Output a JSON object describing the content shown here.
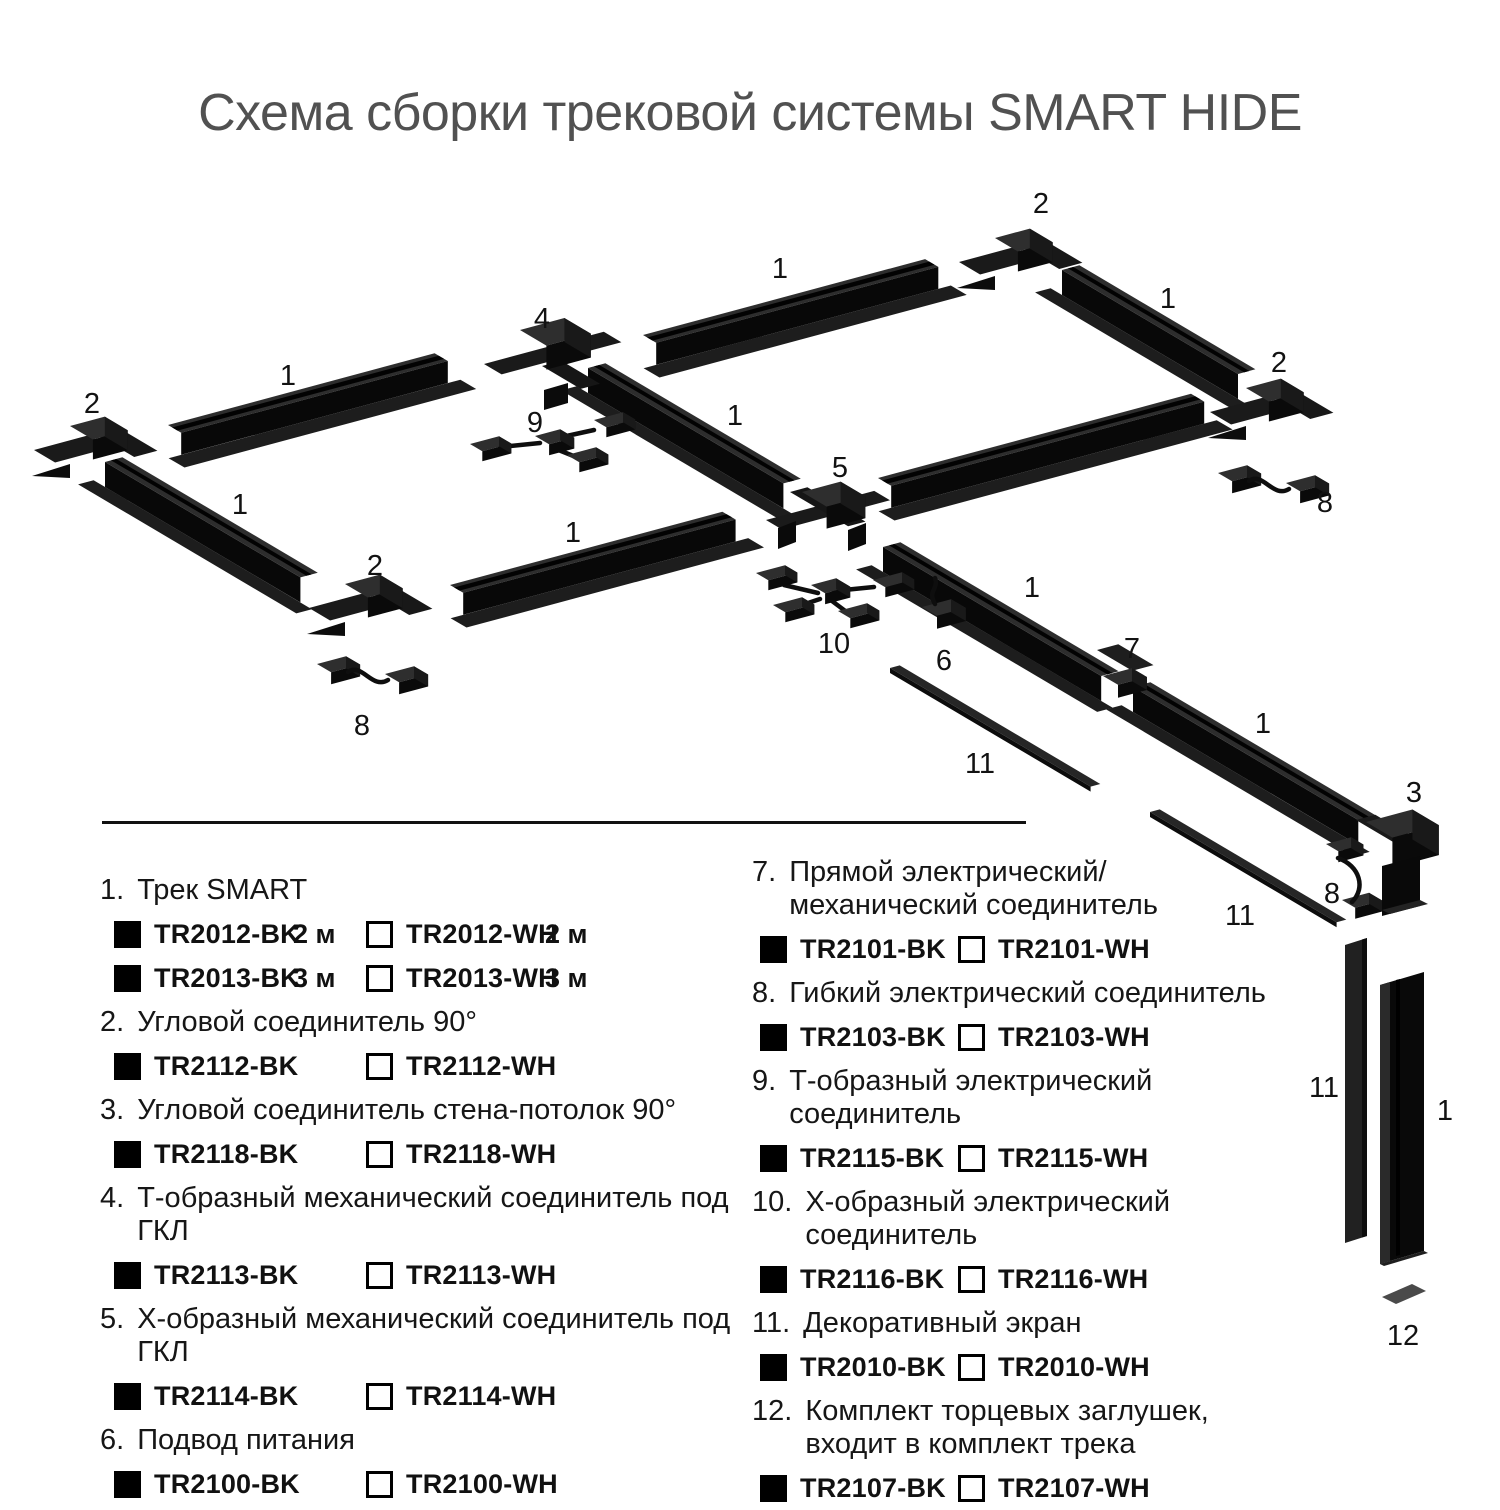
{
  "title": "Схема сборки трековой системы SMART HIDE",
  "colors": {
    "black_variant": "#000000",
    "white_variant": "#FFFFFF",
    "title_gray": "#515151",
    "track_black": "#0a0a0a"
  },
  "diagram": {
    "labels": [
      {
        "t": "2",
        "x": 1041,
        "y": 213
      },
      {
        "t": "1",
        "x": 780,
        "y": 278
      },
      {
        "t": "1",
        "x": 1168,
        "y": 308
      },
      {
        "t": "4",
        "x": 542,
        "y": 328
      },
      {
        "t": "2",
        "x": 1279,
        "y": 372
      },
      {
        "t": "1",
        "x": 288,
        "y": 385
      },
      {
        "t": "2",
        "x": 92,
        "y": 413
      },
      {
        "t": "9",
        "x": 535,
        "y": 432
      },
      {
        "t": "1",
        "x": 735,
        "y": 425
      },
      {
        "t": "5",
        "x": 840,
        "y": 477
      },
      {
        "t": "8",
        "x": 1325,
        "y": 512
      },
      {
        "t": "1",
        "x": 240,
        "y": 514
      },
      {
        "t": "1",
        "x": 573,
        "y": 542
      },
      {
        "t": "2",
        "x": 375,
        "y": 575
      },
      {
        "t": "1",
        "x": 1032,
        "y": 597
      },
      {
        "t": "10",
        "x": 834,
        "y": 653
      },
      {
        "t": "7",
        "x": 1132,
        "y": 658
      },
      {
        "t": "6",
        "x": 944,
        "y": 670
      },
      {
        "t": "1",
        "x": 1263,
        "y": 733
      },
      {
        "t": "8",
        "x": 362,
        "y": 735
      },
      {
        "t": "11",
        "x": 980,
        "y": 773
      },
      {
        "t": "3",
        "x": 1414,
        "y": 802
      },
      {
        "t": "8",
        "x": 1332,
        "y": 903
      },
      {
        "t": "11",
        "x": 1240,
        "y": 925
      },
      {
        "t": "11",
        "x": 1324,
        "y": 1097
      },
      {
        "t": "1",
        "x": 1445,
        "y": 1120
      },
      {
        "t": "12",
        "x": 1403,
        "y": 1345
      }
    ]
  },
  "legend": {
    "left": [
      {
        "num": "1.",
        "name_lines": [
          "Трек SMART"
        ],
        "rows": [
          {
            "bk": "TR2012-BK",
            "bk_len": "2 м",
            "wh": "TR2012-WH",
            "wh_len": "2 м"
          },
          {
            "bk": "TR2013-BK",
            "bk_len": "3 м",
            "wh": "TR2013-WH",
            "wh_len": "3 м"
          }
        ]
      },
      {
        "num": "2.",
        "name_lines": [
          "Угловой соединитель 90°"
        ],
        "rows": [
          {
            "bk": "TR2112-BK",
            "wh": "TR2112-WH"
          }
        ]
      },
      {
        "num": "3.",
        "name_lines": [
          "Угловой соединитель стена-потолок 90°"
        ],
        "rows": [
          {
            "bk": "TR2118-BK",
            "wh": "TR2118-WH"
          }
        ]
      },
      {
        "num": "4.",
        "name_lines": [
          "Т-образный механический соединитель под ГКЛ"
        ],
        "rows": [
          {
            "bk": "TR2113-BK",
            "wh": "TR2113-WH"
          }
        ]
      },
      {
        "num": "5.",
        "name_lines": [
          "Х-образный механический соединитель под ГКЛ"
        ],
        "rows": [
          {
            "bk": "TR2114-BK",
            "wh": "TR2114-WH"
          }
        ]
      },
      {
        "num": "6.",
        "name_lines": [
          "Подвод питания"
        ],
        "rows": [
          {
            "bk": "TR2100-BK",
            "wh": "TR2100-WH"
          }
        ]
      }
    ],
    "right": [
      {
        "num": "7.",
        "name_lines": [
          "Прямой электрический/",
          "механический соединитель"
        ],
        "rows": [
          {
            "bk": "TR2101-BK",
            "wh": "TR2101-WH"
          }
        ]
      },
      {
        "num": "8.",
        "name_lines": [
          "Гибкий электрический соединитель"
        ],
        "rows": [
          {
            "bk": "TR2103-BK",
            "wh": "TR2103-WH"
          }
        ]
      },
      {
        "num": "9.",
        "name_lines": [
          "Т-образный электрический соединитель"
        ],
        "rows": [
          {
            "bk": "TR2115-BK",
            "wh": "TR2115-WH"
          }
        ]
      },
      {
        "num": "10.",
        "name_lines": [
          "Х-образный электрический соединитель"
        ],
        "rows": [
          {
            "bk": "TR2116-BK",
            "wh": "TR2116-WH"
          }
        ]
      },
      {
        "num": "11.",
        "name_lines": [
          "Декоративный экран"
        ],
        "rows": [
          {
            "bk": "TR2010-BK",
            "wh": "TR2010-WH"
          }
        ]
      },
      {
        "num": "12.",
        "name_lines": [
          "Комплект торцевых заглушек,",
          "входит в комплект трека"
        ],
        "rows": [
          {
            "bk": "TR2107-BK",
            "wh": "TR2107-WH"
          }
        ]
      }
    ]
  }
}
